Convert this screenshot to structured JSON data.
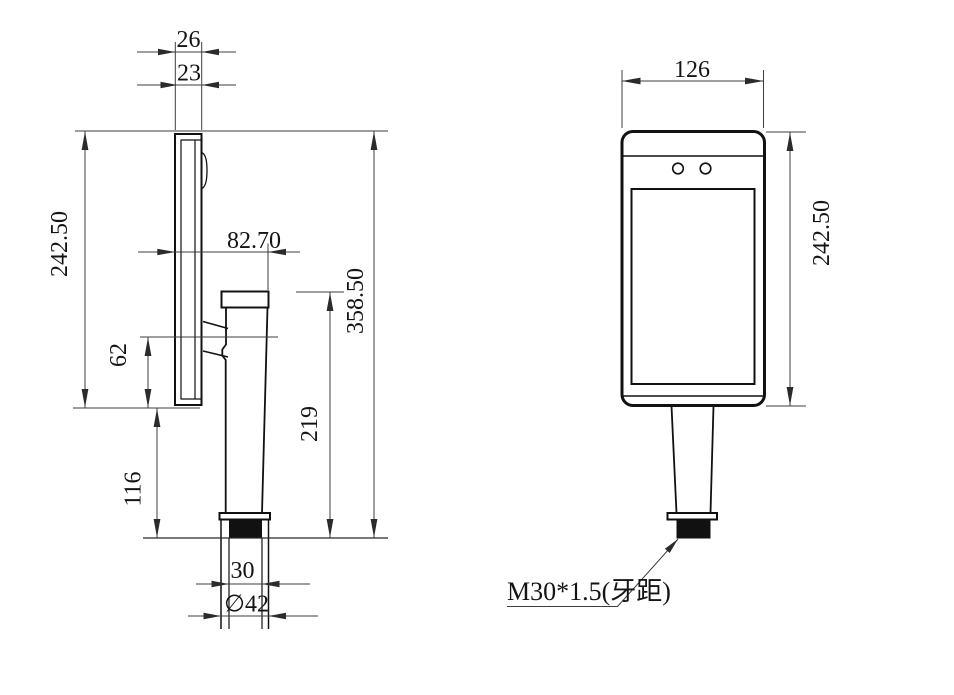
{
  "canvas": {
    "width": 954,
    "height": 695,
    "background": "#ffffff",
    "line_color": "#111111"
  },
  "side_view": {
    "dims": {
      "thickness_outer": "26",
      "thickness_inner": "23",
      "panel_height": "242.50",
      "mount_depth": "82.70",
      "bracket_drop": "62",
      "lower_clearance": "116",
      "pole_height": "219",
      "overall_height": "358.50",
      "thread_width": "30",
      "base_diameter": "∅42"
    }
  },
  "front_view": {
    "dims": {
      "panel_width": "126",
      "panel_height": "242.50"
    },
    "thread_note": "M30*1.5(牙距)"
  }
}
